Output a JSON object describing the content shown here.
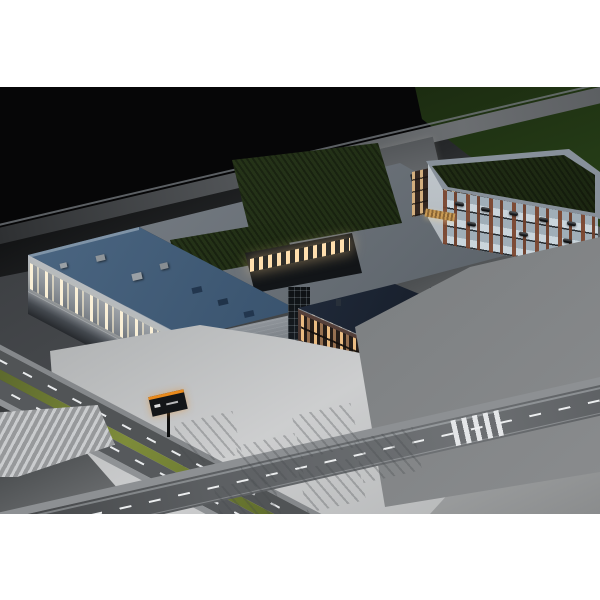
{
  "image_alt": "Night aerial architectural rendering of a business and logistics campus: warehouse with loading docks and section letters, brick office buildings, multi-storey car park, plaza, roads and parking lots",
  "markers": {
    "letter_a": "A",
    "letter_b": "B",
    "letter_c": "C",
    "letter_d": "D",
    "parking_letter": "P"
  },
  "colors": {
    "section_letters": "#f0921e",
    "parking_letter": "#45a3e8",
    "warehouse_roof": "#3c5671",
    "green_roof": "#24311a",
    "night_background": "#07080a",
    "page_background": "#ffffff"
  }
}
